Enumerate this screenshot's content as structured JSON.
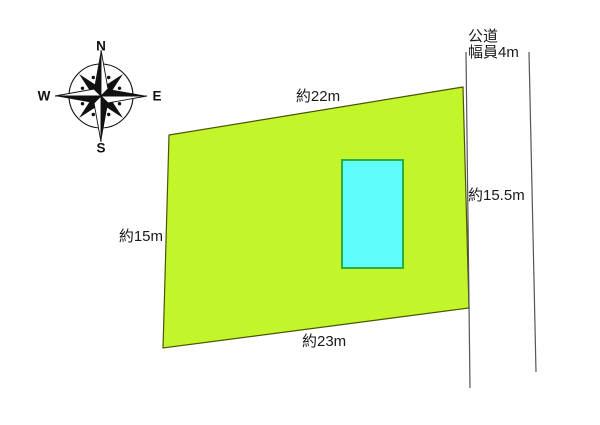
{
  "diagram": {
    "type": "land-plot-survey-diagram",
    "compass": {
      "north": "N",
      "south": "S",
      "east": "E",
      "west": "W"
    },
    "road": {
      "name": "公道",
      "width_label": "幅員4m"
    },
    "parcel": {
      "dimension_top": "約22m",
      "dimension_left": "約15m",
      "dimension_bottom": "約23m",
      "dimension_right": "約15.5m"
    },
    "colors": {
      "parcel_fill": "#c3f52b",
      "parcel_outline": "#4a5505",
      "building_fill": "#5ffcfc",
      "building_outline": "#2fae46",
      "road_line": "#555555",
      "compass_ink": "#111111",
      "text": "#1a1a1a",
      "background": "#ffffff"
    }
  }
}
